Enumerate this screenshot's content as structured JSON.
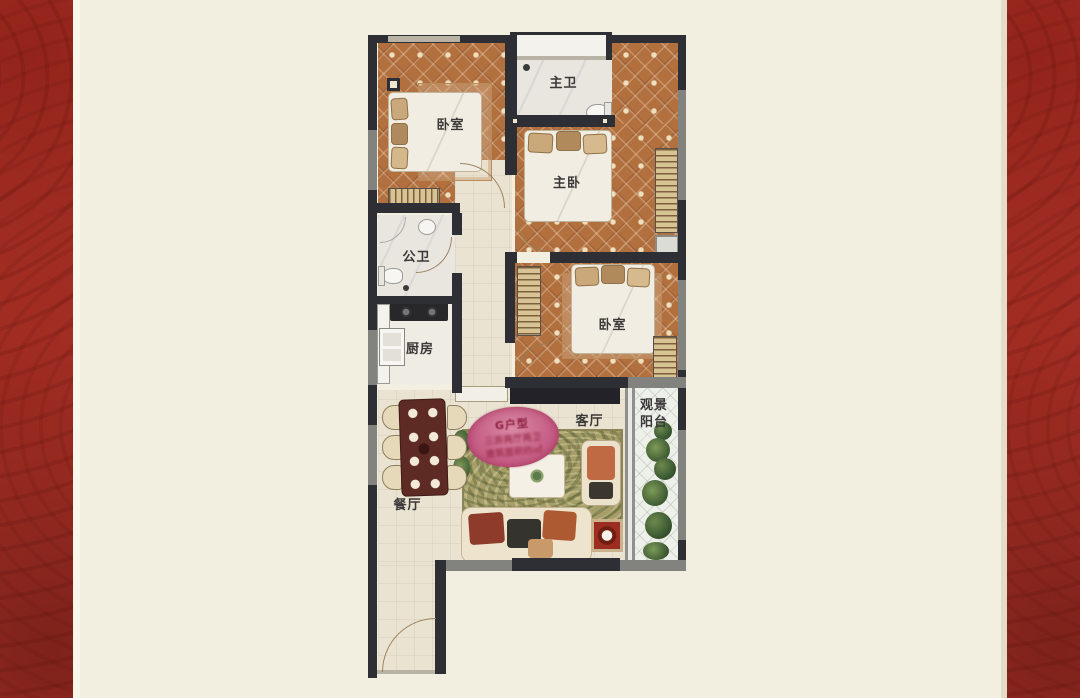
{
  "page": {
    "background_color": "#f2eee0",
    "side_panels": {
      "color": "#a93228",
      "ornament_color": "#7e211b"
    }
  },
  "floorplan": {
    "rooms": [
      {
        "id": "bedroom-top-left",
        "label": "卧室"
      },
      {
        "id": "master-bathroom",
        "label": "主卫"
      },
      {
        "id": "master-bedroom",
        "label": "主卧"
      },
      {
        "id": "public-bathroom",
        "label": "公卫"
      },
      {
        "id": "kitchen",
        "label": "厨房"
      },
      {
        "id": "bedroom-middle",
        "label": "卧室"
      },
      {
        "id": "living-room",
        "label": "客厅"
      },
      {
        "id": "balcony",
        "label": "观景\n阳台"
      },
      {
        "id": "dining-room",
        "label": "餐厅"
      }
    ],
    "unit_badge": {
      "line1": "G户型",
      "line2": "三房两厅两卫",
      "line3": "建筑面积约㎡",
      "background_color": "#c2567e",
      "text_color": "#8e2040"
    },
    "colors": {
      "wall_dark": "#2e2e35",
      "wall_gray": "#82827e",
      "bedroom_floor": "#b3703f",
      "living_floor": "#ebe3d1",
      "bathroom_floor": "#e9e6e0",
      "rug": "#a59e68",
      "balcony_floor": "#eef0ea"
    }
  }
}
